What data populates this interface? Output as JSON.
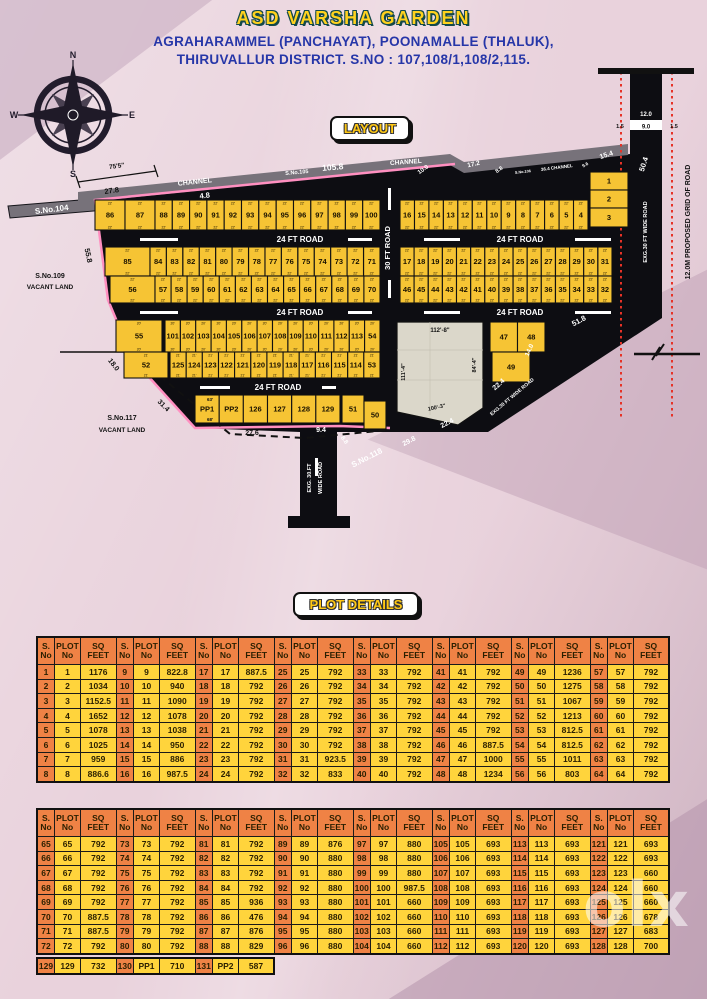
{
  "header": {
    "title": "ASD VARSHA GARDEN",
    "line1": "AGRAHARAMMEL (PANCHAYAT), POONAMALLE (THALUK),",
    "line2": "THIRUVALLUR DISTRICT.  S.NO : 107,108/1,108/2,115.",
    "layout_badge": "LAYOUT",
    "details_badge": "PLOT DETAILS"
  },
  "compass": {
    "n": "N",
    "e": "E",
    "s": "S",
    "w": "W"
  },
  "watermark": {
    "text": "olx"
  },
  "colors": {
    "title_fill": "#ffd21e",
    "title_outline": "#14494a",
    "subtitle": "#2636a8",
    "plot_yellow": "#f6c434",
    "road_black": "#0d0d12",
    "channel_gray": "#77727a",
    "boundary_pink": "#ff8fc0",
    "grid_red": "#e63227",
    "table_orange": "#ef8245",
    "table_yellow": "#ffd43c",
    "open_space": "#dbd7ca"
  },
  "map": {
    "rows": [
      {
        "y": 140,
        "h": 30,
        "dim": "22'",
        "groups": [
          {
            "x1": 95,
            "x2": 155,
            "plots": [
              "86",
              "87"
            ]
          },
          {
            "x1": 155,
            "x2": 380,
            "plots": [
              "88",
              "89",
              "90",
              "91",
              "92",
              "93",
              "94",
              "95",
              "96",
              "97",
              "98",
              "99",
              "100"
            ]
          },
          {
            "x1": 400,
            "x2": 588,
            "plots": [
              "16",
              "15",
              "14",
              "13",
              "12",
              "11",
              "10",
              "9",
              "8",
              "7",
              "6",
              "5",
              "4"
            ]
          }
        ]
      },
      {
        "y": 112,
        "h": 18,
        "groups": [
          {
            "x1": 590,
            "x2": 628,
            "plots": [
              "1"
            ]
          }
        ]
      },
      {
        "y": 130,
        "h": 18,
        "groups": [
          {
            "x1": 590,
            "x2": 628,
            "plots": [
              "2"
            ]
          }
        ]
      },
      {
        "y": 148,
        "h": 19,
        "groups": [
          {
            "x1": 590,
            "x2": 628,
            "plots": [
              "3"
            ]
          }
        ]
      },
      {
        "y": 187,
        "h": 29,
        "dim": "22'",
        "groups": [
          {
            "x1": 105,
            "x2": 150,
            "plots": [
              "85"
            ]
          },
          {
            "x1": 150,
            "x2": 380,
            "plots": [
              "84",
              "83",
              "82",
              "81",
              "80",
              "79",
              "78",
              "77",
              "76",
              "75",
              "74",
              "73",
              "72",
              "71"
            ]
          },
          {
            "x1": 400,
            "x2": 612,
            "plots": [
              "17",
              "18",
              "19",
              "20",
              "21",
              "22",
              "23",
              "24",
              "25",
              "26",
              "27",
              "28",
              "29",
              "30",
              "31"
            ]
          }
        ]
      },
      {
        "y": 216,
        "h": 27,
        "dim": "22'",
        "groups": [
          {
            "x1": 110,
            "x2": 155,
            "plots": [
              "56"
            ]
          },
          {
            "x1": 155,
            "x2": 380,
            "plots": [
              "57",
              "58",
              "59",
              "60",
              "61",
              "62",
              "63",
              "64",
              "65",
              "66",
              "67",
              "68",
              "69",
              "70"
            ]
          },
          {
            "x1": 400,
            "x2": 612,
            "plots": [
              "46",
              "45",
              "44",
              "43",
              "42",
              "41",
              "40",
              "39",
              "38",
              "37",
              "36",
              "35",
              "34",
              "33",
              "32"
            ]
          }
        ]
      },
      {
        "y": 260,
        "h": 32,
        "dim": "20'",
        "groups": [
          {
            "x1": 116,
            "x2": 162,
            "plots": [
              "55"
            ]
          },
          {
            "x1": 165,
            "x2": 380,
            "plots": [
              "101",
              "102",
              "103",
              "104",
              "105",
              "106",
              "107",
              "108",
              "109",
              "110",
              "111",
              "112",
              "113",
              "54"
            ]
          }
        ]
      },
      {
        "y": 292,
        "h": 26,
        "dim": "21'",
        "groups": [
          {
            "x1": 124,
            "x2": 168,
            "plots": [
              "52"
            ]
          },
          {
            "x1": 170,
            "x2": 380,
            "plots": [
              "125",
              "124",
              "123",
              "122",
              "121",
              "120",
              "119",
              "118",
              "117",
              "116",
              "115",
              "114",
              "53"
            ]
          }
        ]
      },
      {
        "y": 335,
        "h": 28,
        "groups": [
          {
            "x1": 195,
            "x2": 340,
            "plots": [
              "PP1",
              "PP2",
              "126",
              "127",
              "128",
              "129"
            ]
          },
          {
            "x1": 342,
            "x2": 364,
            "plots": [
              "51"
            ]
          }
        ]
      },
      {
        "y": 341,
        "h": 28,
        "groups": [
          {
            "x1": 364,
            "x2": 386,
            "plots": [
              "50"
            ]
          }
        ]
      },
      {
        "y": 262,
        "h": 30,
        "groups": [
          {
            "x1": 490,
            "x2": 545,
            "plots": [
              "47",
              "48"
            ]
          }
        ]
      },
      {
        "y": 292,
        "h": 30,
        "groups": [
          {
            "x1": 492,
            "x2": 530,
            "plots": [
              "49"
            ]
          }
        ]
      }
    ],
    "labels": [
      {
        "t": "CHANNEL",
        "x": 195,
        "y": 124,
        "r": -6,
        "s": 7,
        "c": "#fff"
      },
      {
        "t": "S.No.105",
        "x": 297,
        "y": 114,
        "r": -5,
        "s": 5.5,
        "c": "#fff"
      },
      {
        "t": "105.8",
        "x": 333,
        "y": 110,
        "r": -5,
        "s": 8.5,
        "c": "#fff"
      },
      {
        "t": "CHANNEL",
        "x": 406,
        "y": 104,
        "r": -4,
        "s": 6.5,
        "c": "#fff"
      },
      {
        "t": "10.0",
        "x": 424,
        "y": 111,
        "r": -35,
        "s": 6,
        "c": "#fff"
      },
      {
        "t": "17.2",
        "x": 474,
        "y": 106,
        "r": -12,
        "s": 6.5,
        "c": "#fff"
      },
      {
        "t": "8.8",
        "x": 500,
        "y": 111,
        "r": -35,
        "s": 5.5,
        "c": "#fff"
      },
      {
        "t": "S.No.106",
        "x": 523,
        "y": 113,
        "r": -6,
        "s": 3.8,
        "c": "#fff"
      },
      {
        "t": "36.4 CHANNEL",
        "x": 557,
        "y": 109,
        "r": -7,
        "s": 4.5,
        "c": "#fff"
      },
      {
        "t": "9.6",
        "x": 586,
        "y": 106,
        "r": -30,
        "s": 4.5,
        "c": "#fff"
      },
      {
        "t": "15.4",
        "x": 607,
        "y": 97,
        "r": -18,
        "s": 7,
        "c": "#fff"
      },
      {
        "t": "50.4",
        "x": 646,
        "y": 105,
        "r": -72,
        "s": 7.5,
        "c": "#fff"
      },
      {
        "t": "S.No.104",
        "x": 52,
        "y": 152,
        "r": -7,
        "s": 8,
        "c": "#fff"
      },
      {
        "t": "4.8",
        "x": 205,
        "y": 138,
        "r": -7,
        "s": 7.5,
        "c": "#fff"
      },
      {
        "t": "27.8",
        "x": 112,
        "y": 133,
        "r": -8,
        "s": 7.5,
        "c": "#111"
      },
      {
        "t": "75'5\"",
        "x": 117,
        "y": 108,
        "r": -8,
        "s": 6.5,
        "c": "#111"
      },
      {
        "t": "55.8",
        "x": 86,
        "y": 196,
        "r": 78,
        "s": 7.5,
        "c": "#111"
      },
      {
        "t": "S.No.109",
        "x": 50,
        "y": 218,
        "s": 7,
        "c": "#111"
      },
      {
        "t": "VACANT LAND",
        "x": 50,
        "y": 229,
        "s": 6.5,
        "c": "#111"
      },
      {
        "t": "18.0",
        "x": 112,
        "y": 306,
        "r": 52,
        "s": 7,
        "c": "#111"
      },
      {
        "t": "31.4",
        "x": 162,
        "y": 347,
        "r": 45,
        "s": 7,
        "c": "#111"
      },
      {
        "t": "S.No.117",
        "x": 122,
        "y": 360,
        "s": 7,
        "c": "#111"
      },
      {
        "t": "VACANT LAND",
        "x": 122,
        "y": 372,
        "s": 6.5,
        "c": "#111"
      },
      {
        "t": "27.6",
        "x": 252,
        "y": 375,
        "s": 7,
        "c": "#111"
      },
      {
        "t": "24 FT ROAD",
        "x": 300,
        "y": 182,
        "s": 8,
        "c": "#fff"
      },
      {
        "t": "24 FT ROAD",
        "x": 520,
        "y": 182,
        "s": 8,
        "c": "#fff"
      },
      {
        "t": "24 FT ROAD",
        "x": 300,
        "y": 255,
        "s": 8,
        "c": "#fff"
      },
      {
        "t": "24 FT ROAD",
        "x": 520,
        "y": 255,
        "s": 8,
        "c": "#fff"
      },
      {
        "t": "24 FT ROAD",
        "x": 278,
        "y": 330,
        "s": 8,
        "c": "#fff"
      },
      {
        "t": "30 FT ROAD",
        "x": 390,
        "y": 188,
        "r": -90,
        "s": 7.5,
        "c": "#fff"
      },
      {
        "t": "112'-8\"",
        "x": 440,
        "y": 272,
        "s": 6,
        "c": "#111"
      },
      {
        "t": "111'-4\"",
        "x": 405,
        "y": 312,
        "r": -90,
        "s": 5.5,
        "c": "#111"
      },
      {
        "t": "84'-4\"",
        "x": 476,
        "y": 305,
        "r": -90,
        "s": 5.5,
        "c": "#111"
      },
      {
        "t": "100'-3\"",
        "x": 437,
        "y": 349,
        "r": -12,
        "s": 5.5,
        "c": "#111"
      },
      {
        "t": "63'",
        "x": 210,
        "y": 341,
        "s": 4.5,
        "c": "#111"
      },
      {
        "t": "68'",
        "x": 210,
        "y": 361,
        "s": 4.5,
        "c": "#111"
      },
      {
        "t": "9.4",
        "x": 321,
        "y": 372,
        "s": 7,
        "c": "#fff"
      },
      {
        "t": "8.8",
        "x": 343,
        "y": 381,
        "r": 55,
        "s": 6,
        "c": "#fff"
      },
      {
        "t": "S.No.118",
        "x": 368,
        "y": 400,
        "r": -27,
        "s": 8,
        "c": "#fff"
      },
      {
        "t": "29.8",
        "x": 410,
        "y": 383,
        "r": -27,
        "s": 7,
        "c": "#fff"
      },
      {
        "t": "22.4",
        "x": 448,
        "y": 365,
        "r": -27,
        "s": 7,
        "c": "#fff"
      },
      {
        "t": "22.4",
        "x": 500,
        "y": 326,
        "r": -42,
        "s": 7,
        "c": "#fff"
      },
      {
        "t": "EXG.30 FT WIDE ROAD",
        "x": 513,
        "y": 338,
        "r": -40,
        "s": 5,
        "c": "#fff"
      },
      {
        "t": "14.0",
        "x": 531,
        "y": 291,
        "r": -65,
        "s": 6.5,
        "c": "#fff"
      },
      {
        "t": "51.8",
        "x": 580,
        "y": 263,
        "r": -28,
        "s": 7.5,
        "c": "#fff"
      },
      {
        "t": "EXG. 30.FT",
        "x": 311,
        "y": 418,
        "r": -90,
        "s": 5.5,
        "c": "#fff"
      },
      {
        "t": "WIDE ROAD",
        "x": 322,
        "y": 418,
        "r": -90,
        "s": 5.5,
        "c": "#fff"
      },
      {
        "t": "EXG.30 FT WIDE ROAD",
        "x": 647,
        "y": 172,
        "r": -90,
        "s": 5.5,
        "c": "#fff"
      },
      {
        "t": "12.0M PROPOSED GRID OF ROAD",
        "x": 690,
        "y": 162,
        "r": -90,
        "s": 7,
        "c": "#111"
      },
      {
        "t": "12.0",
        "x": 646,
        "y": 56,
        "s": 6,
        "c": "#fff"
      },
      {
        "t": "9.0",
        "x": 646,
        "y": 68.5,
        "s": 6,
        "c": "#111"
      },
      {
        "t": "1.5",
        "x": 620,
        "y": 68,
        "s": 5.5,
        "c": "#111"
      },
      {
        "t": "1.5",
        "x": 674,
        "y": 68,
        "s": 5.5,
        "c": "#111"
      }
    ]
  },
  "tables_header": {
    "s1": "S.",
    "s2": "No",
    "p1": "PLOT",
    "p2": "No",
    "q1": "SQ",
    "q2": "FEET"
  },
  "tables": [
    {
      "groups": [
        {
          "s": [
            "1",
            "2",
            "3",
            "4",
            "5",
            "6",
            "7",
            "8"
          ],
          "q": [
            "1176",
            "1034",
            "1152.5",
            "1652",
            "1078",
            "1025",
            "959",
            "886.6"
          ]
        },
        {
          "s": [
            "9",
            "10",
            "11",
            "12",
            "13",
            "14",
            "15",
            "16"
          ],
          "q": [
            "822.8",
            "940",
            "1090",
            "1078",
            "1038",
            "950",
            "886",
            "987.5"
          ]
        },
        {
          "s": [
            "17",
            "18",
            "19",
            "20",
            "21",
            "22",
            "23",
            "24"
          ],
          "q": [
            "887.5",
            "792",
            "792",
            "792",
            "792",
            "792",
            "792",
            "792"
          ]
        },
        {
          "s": [
            "25",
            "26",
            "27",
            "28",
            "29",
            "30",
            "31",
            "32"
          ],
          "q": [
            "792",
            "792",
            "792",
            "792",
            "792",
            "792",
            "923.5",
            "833"
          ]
        },
        {
          "s": [
            "33",
            "34",
            "35",
            "36",
            "37",
            "38",
            "39",
            "40"
          ],
          "q": [
            "792",
            "792",
            "792",
            "792",
            "792",
            "792",
            "792",
            "792"
          ]
        },
        {
          "s": [
            "41",
            "42",
            "43",
            "44",
            "45",
            "46",
            "47",
            "48"
          ],
          "q": [
            "792",
            "792",
            "792",
            "792",
            "792",
            "887.5",
            "1000",
            "1234"
          ]
        },
        {
          "s": [
            "49",
            "50",
            "51",
            "52",
            "53",
            "54",
            "55",
            "56"
          ],
          "q": [
            "1236",
            "1275",
            "1067",
            "1213",
            "812.5",
            "812.5",
            "1011",
            "803"
          ]
        },
        {
          "s": [
            "57",
            "58",
            "59",
            "60",
            "61",
            "62",
            "63",
            "64"
          ],
          "q": [
            "792",
            "792",
            "792",
            "792",
            "792",
            "792",
            "792",
            "792"
          ]
        }
      ]
    },
    {
      "groups": [
        {
          "s": [
            "65",
            "66",
            "67",
            "68",
            "69",
            "70",
            "71",
            "72"
          ],
          "q": [
            "792",
            "792",
            "792",
            "792",
            "792",
            "887.5",
            "887.5",
            "792"
          ]
        },
        {
          "s": [
            "73",
            "74",
            "75",
            "76",
            "77",
            "78",
            "79",
            "80"
          ],
          "q": [
            "792",
            "792",
            "792",
            "792",
            "792",
            "792",
            "792",
            "792"
          ]
        },
        {
          "s": [
            "81",
            "82",
            "83",
            "84",
            "85",
            "86",
            "87",
            "88"
          ],
          "q": [
            "792",
            "792",
            "792",
            "792",
            "936",
            "476",
            "876",
            "829"
          ]
        },
        {
          "s": [
            "89",
            "90",
            "91",
            "92",
            "93",
            "94",
            "95",
            "96"
          ],
          "q": [
            "876",
            "880",
            "880",
            "880",
            "880",
            "880",
            "880",
            "880"
          ]
        },
        {
          "s": [
            "97",
            "98",
            "99",
            "100",
            "101",
            "102",
            "103",
            "104"
          ],
          "q": [
            "880",
            "880",
            "880",
            "987.5",
            "660",
            "660",
            "660",
            "660"
          ]
        },
        {
          "s": [
            "105",
            "106",
            "107",
            "108",
            "109",
            "110",
            "111",
            "112"
          ],
          "q": [
            "693",
            "693",
            "693",
            "693",
            "693",
            "693",
            "693",
            "693"
          ]
        },
        {
          "s": [
            "113",
            "114",
            "115",
            "116",
            "117",
            "118",
            "119",
            "120"
          ],
          "q": [
            "693",
            "693",
            "693",
            "693",
            "693",
            "693",
            "693",
            "693"
          ]
        },
        {
          "s": [
            "121",
            "122",
            "123",
            "124",
            "125",
            "126",
            "127",
            "128"
          ],
          "q": [
            "693",
            "693",
            "660",
            "660",
            "660",
            "678",
            "683",
            "700"
          ]
        }
      ]
    }
  ],
  "extra_row": {
    "groups": [
      [
        "129",
        "129",
        "732"
      ],
      [
        "130",
        "PP1",
        "710"
      ],
      [
        "131",
        "PP2",
        "587"
      ]
    ]
  }
}
